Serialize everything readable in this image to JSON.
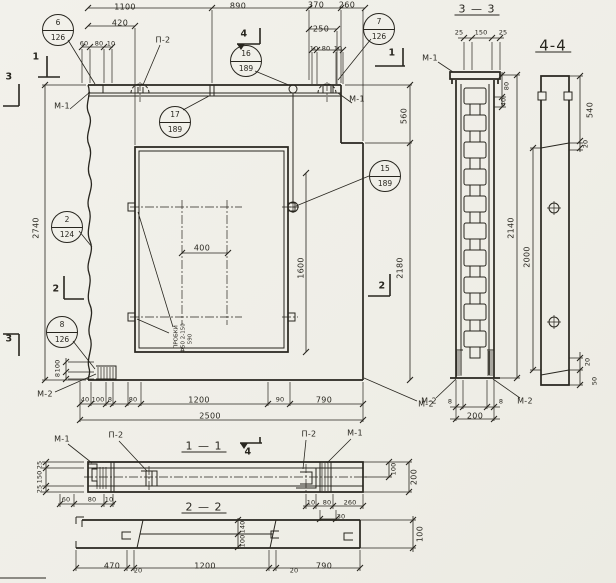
{
  "colors": {
    "background": "#f1f0ea",
    "ink": "#28261f"
  },
  "main_view": {
    "dims_top_row1": [
      "1100",
      "890",
      "370",
      "260"
    ],
    "dims_top_row2": [
      "420",
      "250"
    ],
    "dims_top_small_left": [
      "60",
      "80",
      "10"
    ],
    "dims_top_small_right": [
      "10",
      "80",
      "10"
    ],
    "dim_height_overall": "2740",
    "dim_right_upper": "560",
    "dim_right_lower": "2180",
    "dim_opening_width": "400",
    "dim_opening_height": "1600",
    "dims_bottom_row": [
      "40",
      "100",
      "8",
      "80",
      "1200",
      "90",
      "790"
    ],
    "dim_width_overall": "2500",
    "dims_corner_small": [
      "100",
      "8"
    ],
    "label_p2": "П-2",
    "label_m1_left": "М-1",
    "label_m1_right": "М-1",
    "label_m2_left": "М-2",
    "label_m2_right": "М-2",
    "opening_note": [
      "ПРОБКИ",
      "Ф50 2-150",
      "590"
    ],
    "callouts": {
      "c6": {
        "num": "6",
        "sheet": "126"
      },
      "c7": {
        "num": "7",
        "sheet": "126"
      },
      "c16": {
        "num": "16",
        "sheet": "189"
      },
      "c17": {
        "num": "17",
        "sheet": "189"
      },
      "c15": {
        "num": "15",
        "sheet": "189"
      },
      "c2": {
        "num": "2",
        "sheet": "124"
      },
      "c8": {
        "num": "8",
        "sheet": "126"
      }
    },
    "section_marks": {
      "s1": "1",
      "s2": "2",
      "s3": "3",
      "s4": "4"
    }
  },
  "section_3_3": {
    "title": "3 — 3",
    "dims_top": [
      "25",
      "150",
      "25"
    ],
    "label_m1": "М-1",
    "dim_80": "80",
    "dim_40": "40",
    "dim_2140": "2140",
    "label_m2_left": "М-2",
    "label_m2_right": "М-2",
    "dim_8_left": "8",
    "dim_8_right": "8",
    "dim_200": "200"
  },
  "section_4_4": {
    "title": "4-4",
    "dim_540": "540",
    "dim_20_top": "20",
    "dim_2000": "2000",
    "dim_20_bottom": "20",
    "dim_50": "50"
  },
  "section_1_1": {
    "title": "1 — 1",
    "label_m1_left": "М-1",
    "label_p2_left": "П-2",
    "label_p2_mid": "П-2",
    "label_m1_right": "М-1",
    "dims_left": [
      "25",
      "150",
      "25"
    ],
    "dim_100": "100",
    "dim_200": "200",
    "dims_bottom_left": [
      "60",
      "80",
      "10"
    ],
    "dims_bottom_right": [
      "10",
      "80",
      "260"
    ],
    "dim_30": "30"
  },
  "section_2_2": {
    "title": "2 — 2",
    "dims_bottom": [
      "470",
      "20",
      "1200",
      "20",
      "790"
    ],
    "dim_140": "140",
    "dim_100_mid": "100",
    "dim_100_right": "100"
  }
}
